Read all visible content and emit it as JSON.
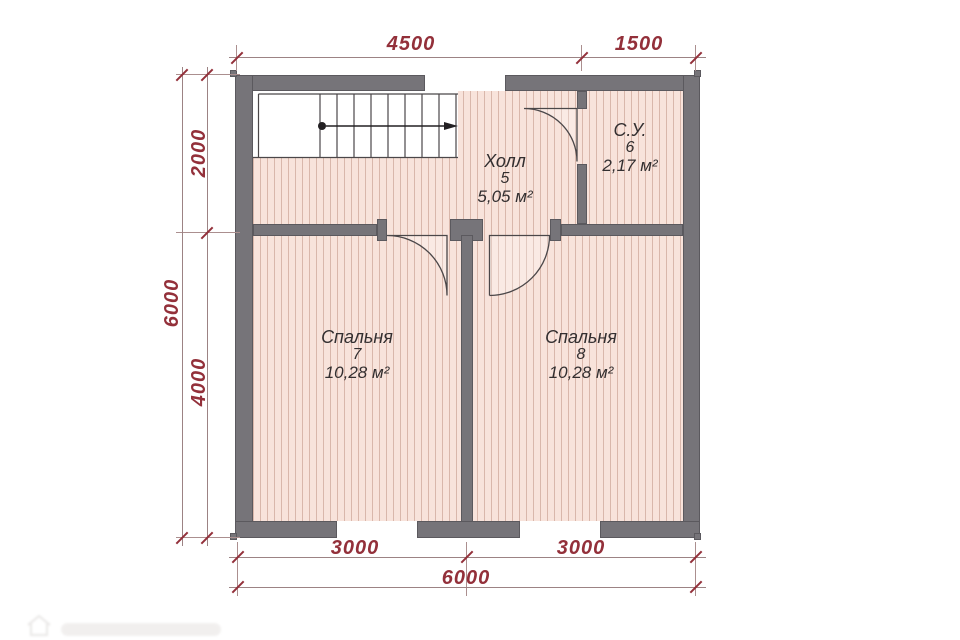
{
  "plan_title": "floor-plan-second-level",
  "rooms": {
    "hall": {
      "name": "Холл",
      "number": "5",
      "area": "5,05 м²"
    },
    "bathroom": {
      "name": "С.У.",
      "number": "6",
      "area": "2,17 м²"
    },
    "bedroom7": {
      "name": "Спальня",
      "number": "7",
      "area": "10,28 м²"
    },
    "bedroom8": {
      "name": "Спальня",
      "number": "8",
      "area": "10,28 м²"
    }
  },
  "dimensions": {
    "top_4500": "4500",
    "top_1500": "1500",
    "left_6000": "6000",
    "left_2000": "2000",
    "left_4000": "4000",
    "bottom_3000_left": "3000",
    "bottom_3000_right": "3000",
    "bottom_6000": "6000"
  },
  "colors": {
    "wall": "#767479",
    "wall_outline": "#5b595e",
    "floor": "#f8e3db",
    "floor_stripe": "#d9b7ab",
    "dimension_accent": "#93303a",
    "linework": "#4b4749"
  }
}
